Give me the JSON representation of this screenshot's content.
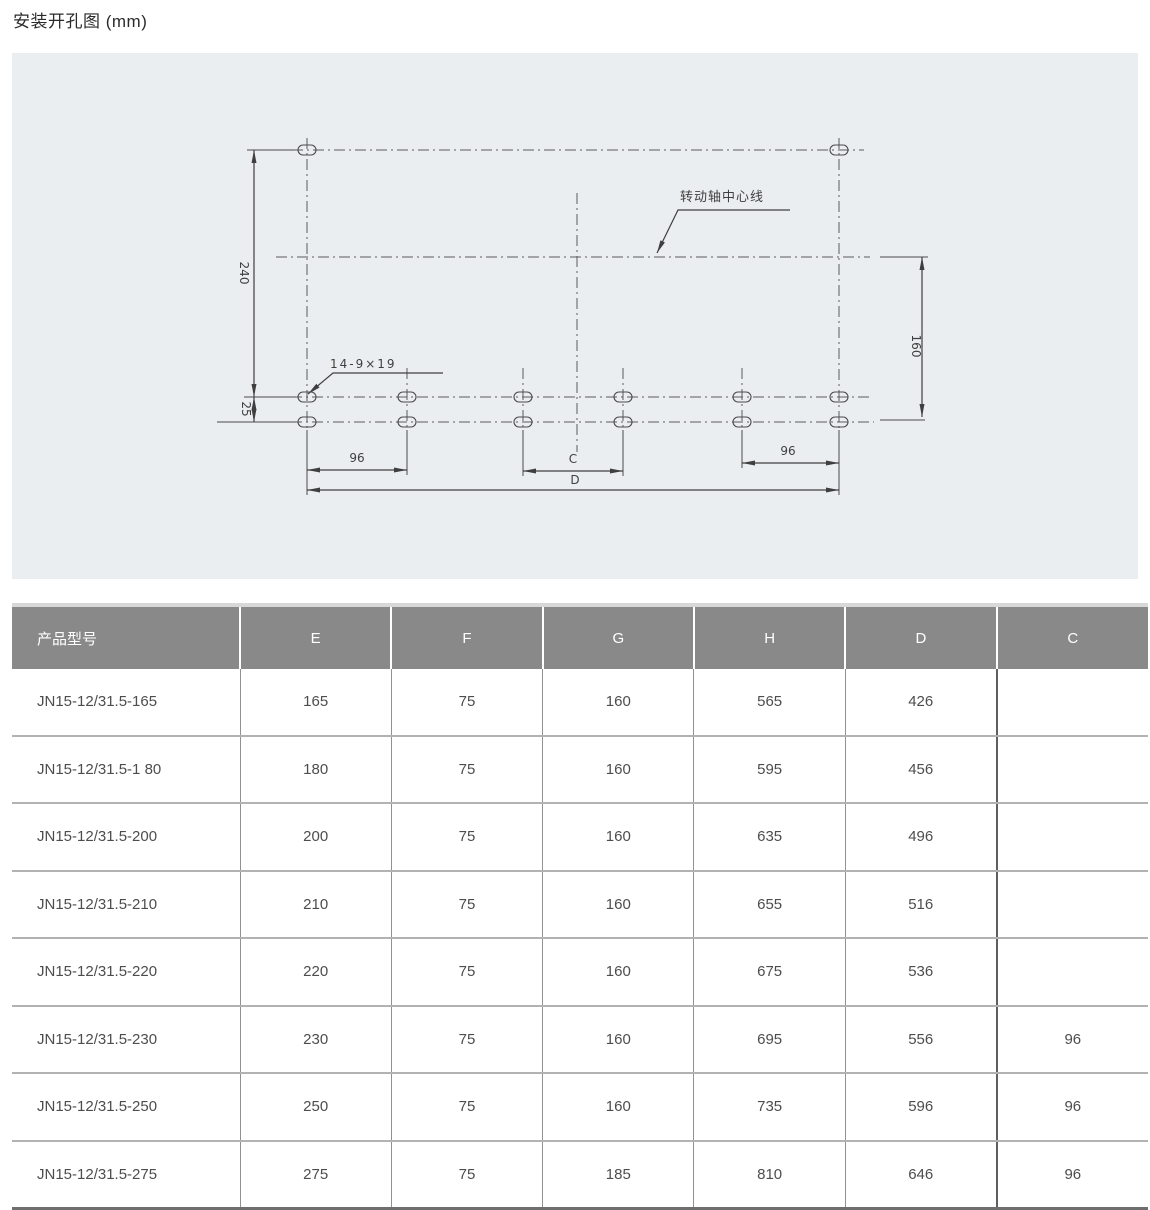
{
  "page": {
    "title": "安装开孔图 (mm)"
  },
  "drawing": {
    "labels": {
      "dim_240": "240",
      "dim_25": "25",
      "dim_96_left": "96",
      "dim_c": "C",
      "dim_d": "D",
      "dim_96_right": "96",
      "dim_160": "160",
      "hole_spec": "14-9×19",
      "axis_note": "转动轴中心线"
    }
  },
  "table": {
    "columns": [
      "产品型号",
      "E",
      "F",
      "G",
      "H",
      "D",
      "C"
    ],
    "rows": [
      {
        "cells": [
          "JN15-12/31.5-165",
          "165",
          "75",
          "160",
          "565",
          "426",
          ""
        ]
      },
      {
        "cells": [
          "JN15-12/31.5-1 80",
          "180",
          "75",
          "160",
          "595",
          "456",
          ""
        ]
      },
      {
        "cells": [
          "JN15-12/31.5-200",
          "200",
          "75",
          "160",
          "635",
          "496",
          ""
        ]
      },
      {
        "cells": [
          "JN15-12/31.5-210",
          "210",
          "75",
          "160",
          "655",
          "516",
          ""
        ]
      },
      {
        "cells": [
          "JN15-12/31.5-220",
          "220",
          "75",
          "160",
          "675",
          "536",
          ""
        ]
      },
      {
        "cells": [
          "JN15-12/31.5-230",
          "230",
          "75",
          "160",
          "695",
          "556",
          "96"
        ]
      },
      {
        "cells": [
          "JN15-12/31.5-250",
          "250",
          "75",
          "160",
          "735",
          "596",
          "96"
        ]
      },
      {
        "cells": [
          "JN15-12/31.5-275",
          "275",
          "75",
          "185",
          "810",
          "646",
          "96"
        ]
      }
    ]
  },
  "colors": {
    "header_bg": "#898989",
    "panel_bg": "#ebeef0",
    "line": "#4a4a4a",
    "row_separator": "#b2b2b2"
  }
}
